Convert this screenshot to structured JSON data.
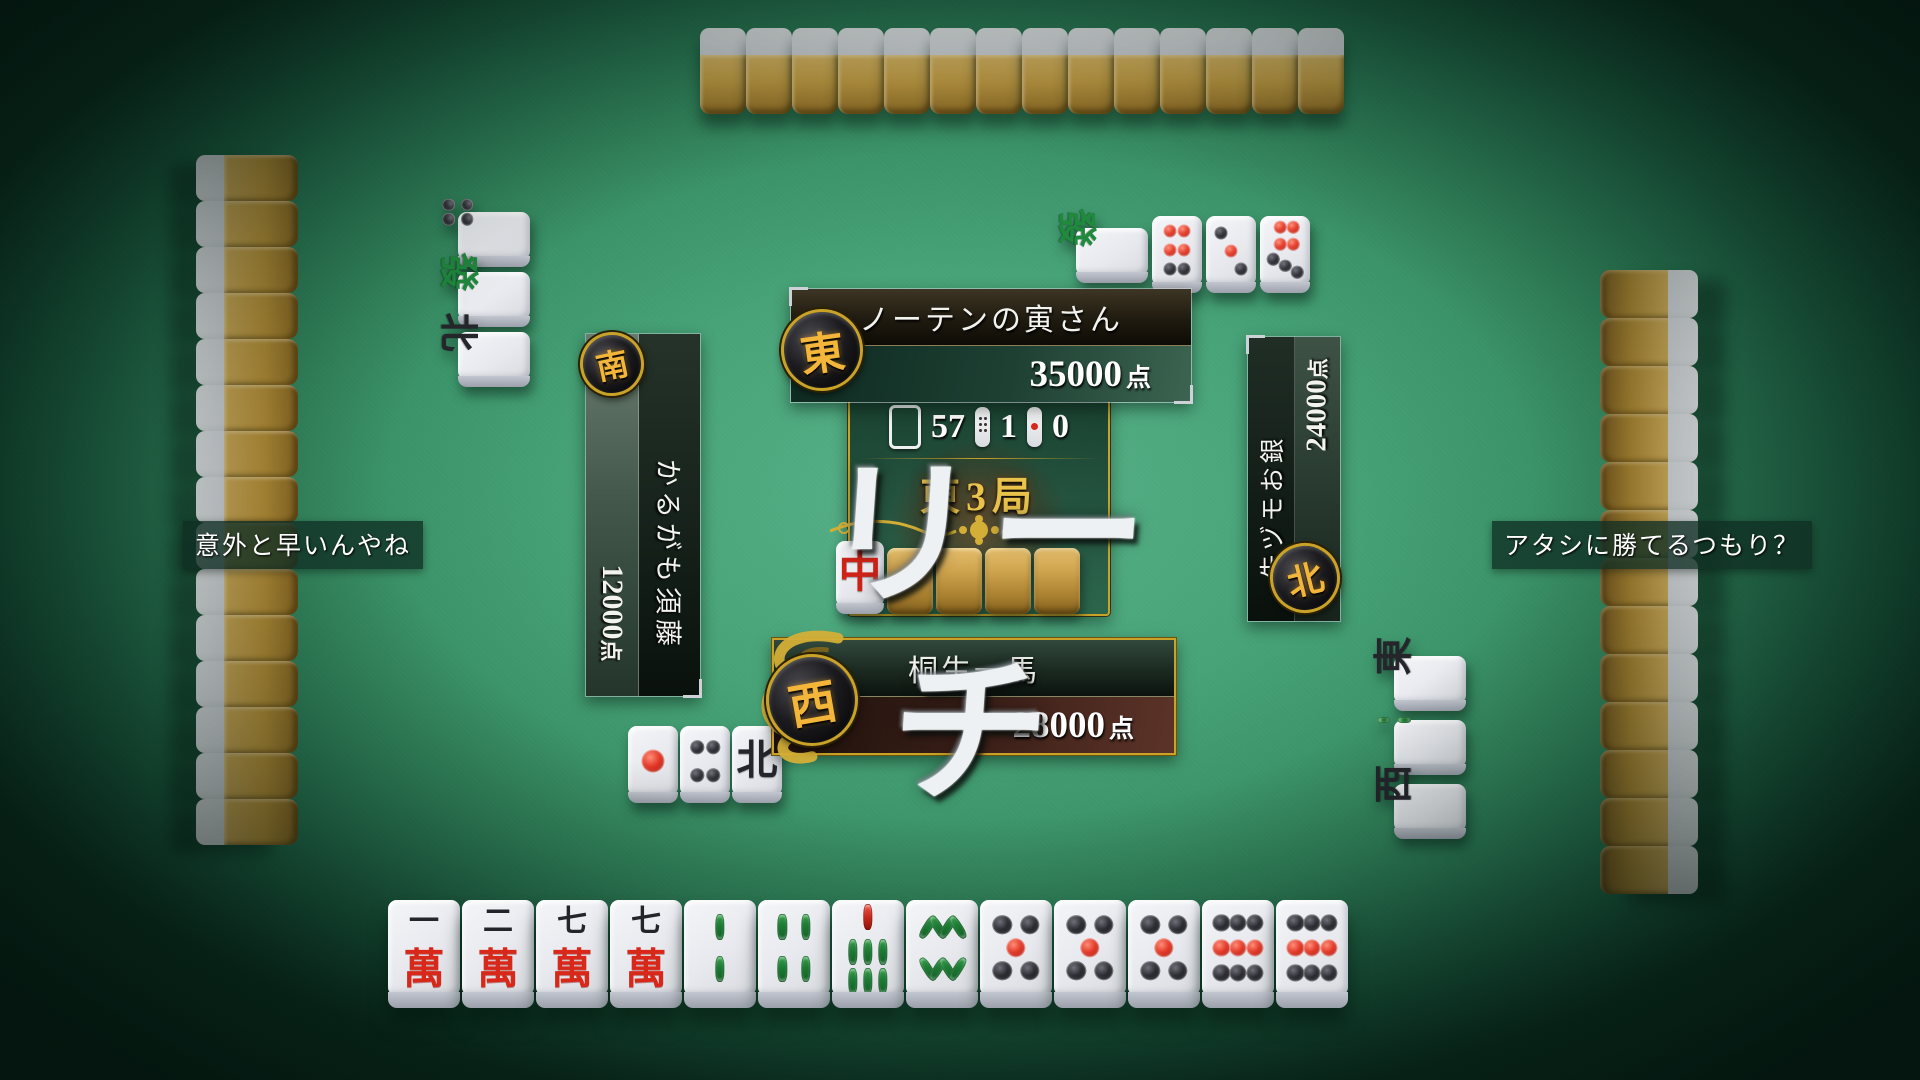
{
  "table": {
    "riichi_banner": "リーチ",
    "center": {
      "remaining": "57",
      "honba": "1",
      "riichi_sticks": "0",
      "round": "東3局",
      "dora_indicator": "chun",
      "dora_facedown_count": 4
    },
    "colors": {
      "felt": "#3f9a71",
      "gold": "#c9a227",
      "tile_back_gold": "#c69e44",
      "riichi_red": "#d8281a"
    }
  },
  "players": {
    "top": {
      "name": "ノーテンの寅さん",
      "score": "35000",
      "score_suffix": "点",
      "wind": "東"
    },
    "left": {
      "name": "かるがも須藤",
      "score": "12000",
      "score_suffix": "点",
      "wind": "南"
    },
    "right": {
      "name": "先ヅモお銀",
      "score": "24000",
      "score_suffix": "点",
      "wind": "北"
    },
    "bottom": {
      "name": "桐生一馬",
      "score": "28000",
      "score_suffix": "点",
      "wind": "西"
    }
  },
  "speech": {
    "left": "意外と早いんやね",
    "right": "アタシに勝てるつもり？"
  },
  "hand": [
    "1m",
    "2m",
    "7m",
    "7m",
    "2s",
    "4s",
    "7s",
    "8s",
    "5p",
    "5p",
    "5p",
    "9p",
    "9p"
  ],
  "discards": {
    "top": [
      {
        "tile": "green",
        "rot": "cw"
      },
      {
        "tile": "6p"
      },
      {
        "tile": "3p"
      },
      {
        "tile": "7p"
      }
    ],
    "left": [
      {
        "tile": "4p",
        "rot": "cw"
      },
      {
        "tile": "green",
        "rot": "cw"
      },
      {
        "tile": "north",
        "rot": "cw"
      }
    ],
    "right": [
      {
        "tile": "east",
        "rot": "ccw"
      },
      {
        "tile": "2s",
        "rot": "ccw"
      },
      {
        "tile": "west",
        "rot": "ccw"
      }
    ],
    "bottom": [
      {
        "tile": "1p"
      },
      {
        "tile": "4p"
      },
      {
        "tile": "north"
      }
    ]
  },
  "walls": {
    "top": 14,
    "left": 15,
    "right": 13
  }
}
